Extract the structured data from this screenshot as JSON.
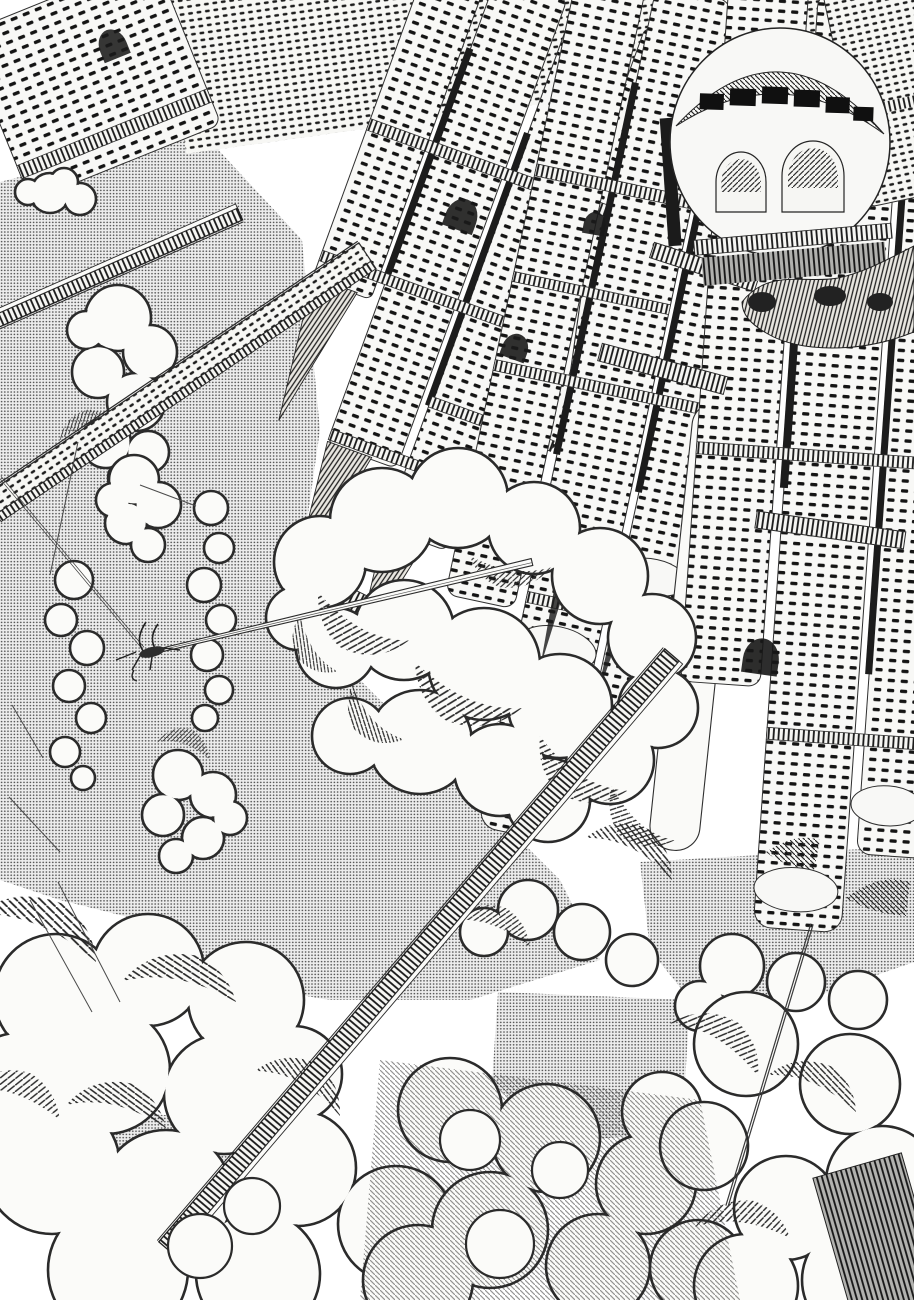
{
  "meta": {
    "title": "Monochrome manga illustration",
    "aria_label": "Black and white ink drawing of a vast leaning tower city rising above cumulus clouds, with truss bridges, a long thin spear bridge towed by a tiny aircraft, and halftone screentone sky",
    "artwork_type": "pen-and-ink comic page with halftone screentone, no text"
  },
  "palette": {
    "paper": "#fbfbf9",
    "facade": "#f8f8f6",
    "ink": "#1a1a1a",
    "line": "#2b2b2b",
    "tone_bg": "#ededed",
    "tone_dot": "#565656"
  },
  "scene": {
    "sky_patches": [
      {
        "name": "sky-main-left",
        "points": [
          [
            0,
            182
          ],
          [
            200,
            130
          ],
          [
            302,
            240
          ],
          [
            320,
            430
          ],
          [
            300,
            570
          ],
          [
            345,
            665
          ],
          [
            470,
            790
          ],
          [
            560,
            880
          ],
          [
            600,
            960
          ],
          [
            470,
            1000
          ],
          [
            330,
            1000
          ],
          [
            210,
            980
          ],
          [
            140,
            920
          ],
          [
            60,
            900
          ],
          [
            0,
            880
          ]
        ]
      },
      {
        "name": "sky-right-low",
        "points": [
          [
            640,
            862
          ],
          [
            914,
            846
          ],
          [
            914,
            962
          ],
          [
            800,
            1002
          ],
          [
            700,
            1012
          ],
          [
            650,
            950
          ]
        ]
      },
      {
        "name": "sky-center-low",
        "points": [
          [
            498,
            992
          ],
          [
            690,
            1000
          ],
          [
            682,
            1132
          ],
          [
            558,
            1142
          ],
          [
            492,
            1082
          ]
        ]
      },
      {
        "name": "sky-left-low",
        "points": [
          [
            88,
            1112
          ],
          [
            242,
            1118
          ],
          [
            232,
            1212
          ],
          [
            98,
            1206
          ]
        ]
      }
    ],
    "clouds": [
      {
        "name": "cloud-left-edge",
        "bumps": [
          [
            50,
            193,
            20
          ],
          [
            80,
            199,
            16
          ],
          [
            28,
            192,
            13
          ],
          [
            64,
            182,
            14
          ]
        ]
      },
      {
        "name": "cloud-left-tall",
        "bumps": [
          [
            118,
            318,
            33
          ],
          [
            150,
            352,
            27
          ],
          [
            98,
            372,
            26
          ],
          [
            136,
            402,
            29
          ],
          [
            106,
            443,
            25
          ],
          [
            148,
            452,
            21
          ],
          [
            126,
            478,
            18
          ],
          [
            86,
            330,
            19
          ]
        ]
      },
      {
        "name": "cloud-mid-upper",
        "bumps": [
          [
            134,
            480,
            25
          ],
          [
            158,
            505,
            23
          ],
          [
            126,
            523,
            21
          ],
          [
            148,
            545,
            17
          ],
          [
            113,
            500,
            17
          ]
        ]
      },
      {
        "name": "cloud-column-a",
        "bumps": [
          [
            211,
            508,
            17
          ],
          [
            219,
            548,
            15
          ],
          [
            204,
            585,
            17
          ],
          [
            221,
            620,
            15
          ],
          [
            207,
            655,
            16
          ],
          [
            219,
            690,
            14
          ],
          [
            205,
            718,
            13
          ]
        ]
      },
      {
        "name": "cloud-column-b",
        "bumps": [
          [
            74,
            580,
            19
          ],
          [
            61,
            620,
            16
          ],
          [
            87,
            648,
            17
          ],
          [
            69,
            686,
            16
          ],
          [
            91,
            718,
            15
          ],
          [
            65,
            752,
            15
          ],
          [
            83,
            778,
            12
          ]
        ]
      },
      {
        "name": "cloud-left-low",
        "bumps": [
          [
            178,
            775,
            25
          ],
          [
            213,
            795,
            23
          ],
          [
            163,
            815,
            21
          ],
          [
            203,
            838,
            21
          ],
          [
            176,
            856,
            17
          ],
          [
            230,
            818,
            17
          ]
        ]
      },
      {
        "name": "cloud-central-large",
        "bumps": [
          [
            320,
            562,
            46
          ],
          [
            382,
            520,
            52
          ],
          [
            458,
            498,
            50
          ],
          [
            534,
            528,
            46
          ],
          [
            600,
            576,
            48
          ],
          [
            652,
            638,
            44
          ],
          [
            658,
            708,
            40
          ],
          [
            610,
            760,
            44
          ],
          [
            548,
            800,
            42
          ],
          [
            560,
            706,
            52
          ],
          [
            484,
            664,
            56
          ],
          [
            404,
            630,
            50
          ],
          [
            336,
            648,
            40
          ],
          [
            420,
            742,
            52
          ],
          [
            500,
            770,
            46
          ],
          [
            350,
            736,
            38
          ],
          [
            298,
            618,
            32
          ]
        ]
      },
      {
        "name": "cloud-under-city-right",
        "bumps": [
          [
            528,
            910,
            30
          ],
          [
            582,
            932,
            28
          ],
          [
            632,
            960,
            26
          ],
          [
            484,
            932,
            24
          ],
          [
            732,
            966,
            32
          ],
          [
            796,
            982,
            29
          ],
          [
            858,
            1000,
            29
          ],
          [
            700,
            1006,
            25
          ]
        ]
      },
      {
        "name": "cloud-bottom-left",
        "bumps": [
          [
            56,
            996,
            62
          ],
          [
            148,
            970,
            56
          ],
          [
            246,
            1000,
            58
          ],
          [
            106,
            1070,
            64
          ],
          [
            224,
            1094,
            60
          ],
          [
            52,
            1166,
            68
          ],
          [
            166,
            1196,
            66
          ],
          [
            298,
            1168,
            58
          ],
          [
            294,
            1074,
            48
          ],
          [
            396,
            1224,
            58
          ],
          [
            118,
            1270,
            70
          ],
          [
            258,
            1274,
            62
          ],
          [
            18,
            1088,
            55
          ]
        ]
      },
      {
        "name": "cloud-bottom-middle",
        "bumps": [
          [
            450,
            1110,
            52
          ],
          [
            546,
            1138,
            54
          ],
          [
            646,
            1184,
            50
          ],
          [
            490,
            1230,
            58
          ],
          [
            598,
            1266,
            52
          ],
          [
            418,
            1280,
            55
          ],
          [
            698,
            1268,
            48
          ],
          [
            662,
            1112,
            40
          ]
        ]
      },
      {
        "name": "cloud-bottom-right",
        "bumps": [
          [
            746,
            1044,
            52
          ],
          [
            850,
            1084,
            50
          ],
          [
            882,
            1182,
            56
          ],
          [
            786,
            1208,
            52
          ],
          [
            704,
            1146,
            44
          ],
          [
            860,
            1280,
            58
          ],
          [
            746,
            1286,
            52
          ]
        ]
      }
    ],
    "cloud_shadows": [
      {
        "x": 318,
        "y": 592,
        "sx": 1.5,
        "sy": 1.3,
        "rot": 12,
        "p": "hA"
      },
      {
        "x": 415,
        "y": 662,
        "sx": 1.7,
        "sy": 1.4,
        "rot": 8,
        "p": "hA"
      },
      {
        "x": 540,
        "y": 736,
        "sx": 1.5,
        "sy": 1.3,
        "rot": 16,
        "p": "hA"
      },
      {
        "x": 612,
        "y": 786,
        "sx": 1.2,
        "sy": 1.1,
        "rot": 24,
        "p": "hA"
      },
      {
        "x": 352,
        "y": 684,
        "sx": 1.1,
        "sy": 1.0,
        "rot": 30,
        "p": "hB"
      },
      {
        "x": 470,
        "y": 556,
        "sx": 1.2,
        "sy": 0.9,
        "rot": -6,
        "p": "hA"
      },
      {
        "x": 300,
        "y": 614,
        "sx": 1.0,
        "sy": 0.9,
        "rot": 40,
        "p": "hB"
      },
      {
        "x": 96,
        "y": 962,
        "sx": 1.9,
        "sy": 1.4,
        "rot": 188,
        "p": "hB"
      },
      {
        "x": 236,
        "y": 1002,
        "sx": 1.7,
        "sy": 1.3,
        "rot": 176,
        "p": "hB"
      },
      {
        "x": 340,
        "y": 1116,
        "sx": 1.4,
        "sy": 1.2,
        "rot": 192,
        "p": "hB"
      },
      {
        "x": 60,
        "y": 1120,
        "sx": 1.4,
        "sy": 1.2,
        "rot": 182,
        "p": "hA"
      },
      {
        "x": 166,
        "y": 1128,
        "sx": 1.5,
        "sy": 1.2,
        "rot": 178,
        "p": "hB"
      },
      {
        "x": 758,
        "y": 1076,
        "sx": 1.5,
        "sy": 1.2,
        "rot": 196,
        "p": "hA"
      },
      {
        "x": 856,
        "y": 1112,
        "sx": 1.4,
        "sy": 1.1,
        "rot": 188,
        "p": "hB"
      },
      {
        "x": 790,
        "y": 1238,
        "sx": 1.4,
        "sy": 1.1,
        "rot": 172,
        "p": "hA"
      },
      {
        "x": 120,
        "y": 426,
        "sx": 0.9,
        "sy": 0.8,
        "rot": 150,
        "p": "hA"
      },
      {
        "x": 210,
        "y": 760,
        "sx": 0.8,
        "sy": 0.8,
        "rot": 180,
        "p": "hA"
      },
      {
        "x": 530,
        "y": 948,
        "sx": 1.2,
        "sy": 1.0,
        "rot": 184,
        "p": "hA"
      },
      {
        "x": 672,
        "y": 880,
        "sx": 1.4,
        "sy": 1.2,
        "rot": 190,
        "p": "hB"
      }
    ],
    "bridges": [
      {
        "name": "bridge-upper-left",
        "type": "truss",
        "x1": -10,
        "y1": 324,
        "x2": 240,
        "y2": 214,
        "w": 13
      },
      {
        "name": "viaduct-upper-left",
        "type": "viaduct",
        "x1": -10,
        "y1": 505,
        "x2": 365,
        "y2": 252,
        "w": 22
      },
      {
        "name": "bridge-long-diagonal",
        "type": "truss",
        "x1": 672,
        "y1": 655,
        "x2": 166,
        "y2": 1248,
        "w": 19
      },
      {
        "name": "bridge-thin-spear",
        "type": "thin",
        "x1": 150,
        "y1": 652,
        "x2": 532,
        "y2": 562,
        "w": 7
      },
      {
        "name": "cable-right",
        "type": "cable",
        "x1": 812,
        "y1": 924,
        "x2": 727,
        "y2": 1206,
        "w": 2.4
      },
      {
        "name": "cable-aircraft",
        "type": "cable",
        "x1": 0,
        "y1": 477,
        "x2": 143,
        "y2": 648,
        "w": 1.4
      }
    ],
    "scratch_lines": [
      [
        50,
        575,
        78,
        442
      ],
      [
        12,
        705,
        43,
        758
      ],
      [
        9,
        797,
        60,
        852
      ],
      [
        140,
        485,
        196,
        506
      ],
      [
        30,
        900,
        92,
        1012
      ],
      [
        58,
        882,
        120,
        1002
      ]
    ],
    "aircraft": {
      "x": 150,
      "y": 650
    },
    "overlays": {
      "dark_roll_region": [
        [
          380,
          1060
        ],
        [
          700,
          1100
        ],
        [
          740,
          1300
        ],
        [
          360,
          1300
        ]
      ],
      "white_crests": [
        [
          470,
          1140,
          30
        ],
        [
          560,
          1170,
          28
        ],
        [
          500,
          1244,
          34
        ],
        [
          200,
          1246,
          32
        ],
        [
          252,
          1206,
          28
        ]
      ]
    }
  }
}
